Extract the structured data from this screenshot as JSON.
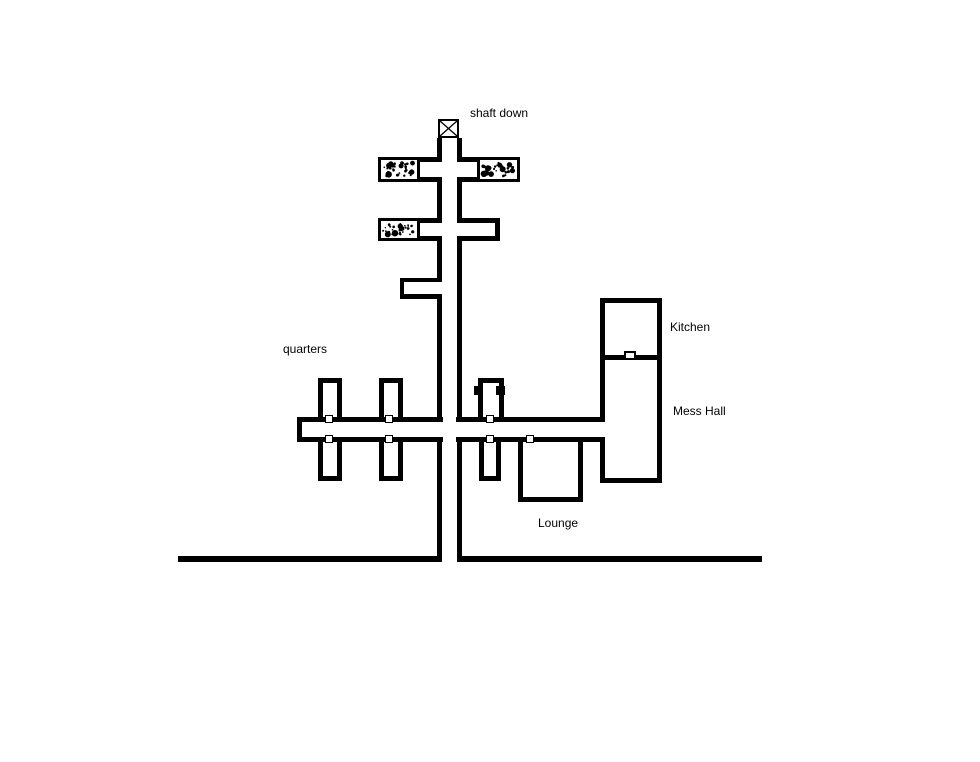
{
  "canvas": {
    "width_px": 980,
    "height_px": 762,
    "background_color": "#ffffff",
    "line_color": "#000000"
  },
  "labels": {
    "shaft_down": "shaft down",
    "quarters": "quarters",
    "kitchen": "Kitchen",
    "mess_hall": "Mess Hall",
    "lounge": "Lounge"
  },
  "symbols": {
    "shaft_icon": "square with X diagonals marking shaft down",
    "door_icon": "small white square across a wall",
    "solid_door_tab_icon": "solid black tab on room wall",
    "rubble_icon": "speckle-filled blocked passage"
  },
  "counts": {
    "door_markers": 8,
    "rubble_passages": 3,
    "quarters_rooms": 6,
    "solid_door_tabs": 2
  }
}
